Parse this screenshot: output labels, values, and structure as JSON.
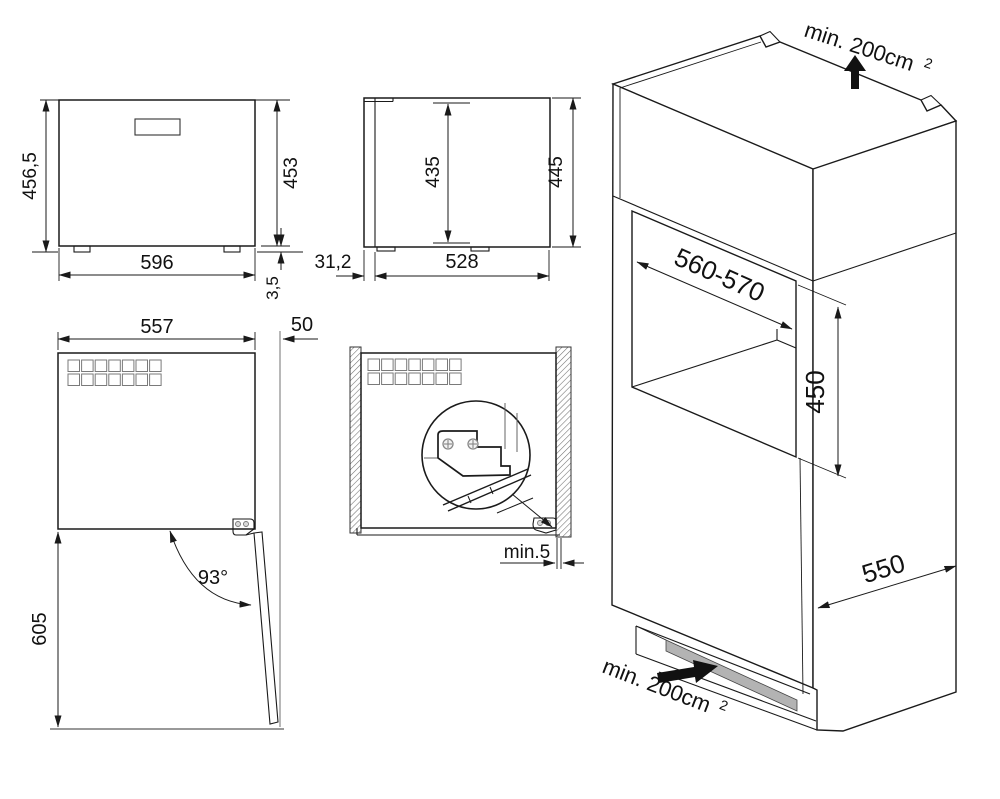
{
  "diagram": {
    "background": "#ffffff",
    "ink": "#1a1a1a",
    "vent_slot_gray": "#b3b3b3",
    "views": {
      "front_view": {
        "total_height": "456,5",
        "body_height": "453",
        "width": "596",
        "feet_height": "3,5"
      },
      "side_view": {
        "inner_height": "435",
        "overall_height": "445",
        "door_protrusion": "31,2",
        "body_depth": "528"
      },
      "top_view_door_open": {
        "body_width": "557",
        "side_clearance": "50",
        "door_opening_angle": "93°",
        "door_swing_depth": "605"
      },
      "top_view_installed": {
        "min_side_gap": "min.5"
      },
      "installation_view": {
        "top_ventilation": "min. 200cm",
        "top_ventilation_sup": "2",
        "niche_width": "560-570",
        "niche_height": "450",
        "cabinet_depth": "550",
        "bottom_ventilation": "min. 200cm",
        "bottom_ventilation_sup": "2"
      }
    }
  }
}
